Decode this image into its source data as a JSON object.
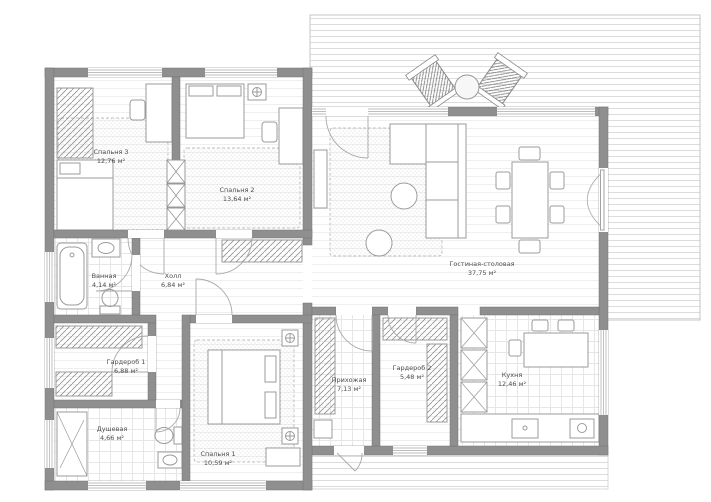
{
  "plan": {
    "type": "floor-plan",
    "unit_suffix": "м²"
  },
  "colors": {
    "wall": "#8f8f8f",
    "furniture_line": "#9b9b9b",
    "label_text": "#4d4d4d",
    "carpet_dot": "#c6c6c6",
    "deck_line": "#dcdcdc",
    "floor_line": "#ededed"
  },
  "rooms": [
    {
      "id": "bedroom-3",
      "name": "Спальня 3",
      "area": "12,76 м²"
    },
    {
      "id": "bedroom-2",
      "name": "Спальня 2",
      "area": "13,64 м²"
    },
    {
      "id": "living",
      "name": "Гостиная-столовая",
      "area": "37,75 м²"
    },
    {
      "id": "bathroom",
      "name": "Ванная",
      "area": "4,14 м²"
    },
    {
      "id": "hall",
      "name": "Холл",
      "area": "6,84 м²"
    },
    {
      "id": "wardrobe-1",
      "name": "Гардероб 1",
      "area": "6,88 м²"
    },
    {
      "id": "shower",
      "name": "Душевая",
      "area": "4,66 м²"
    },
    {
      "id": "bedroom-1",
      "name": "Спальня 1",
      "area": "10,59 м²"
    },
    {
      "id": "entry",
      "name": "Прихожая",
      "area": "7,13 м²"
    },
    {
      "id": "wardrobe-2",
      "name": "Гардероб 2",
      "area": "5,48 м²"
    },
    {
      "id": "kitchen",
      "name": "Кухня",
      "area": "12,46 м²"
    }
  ]
}
